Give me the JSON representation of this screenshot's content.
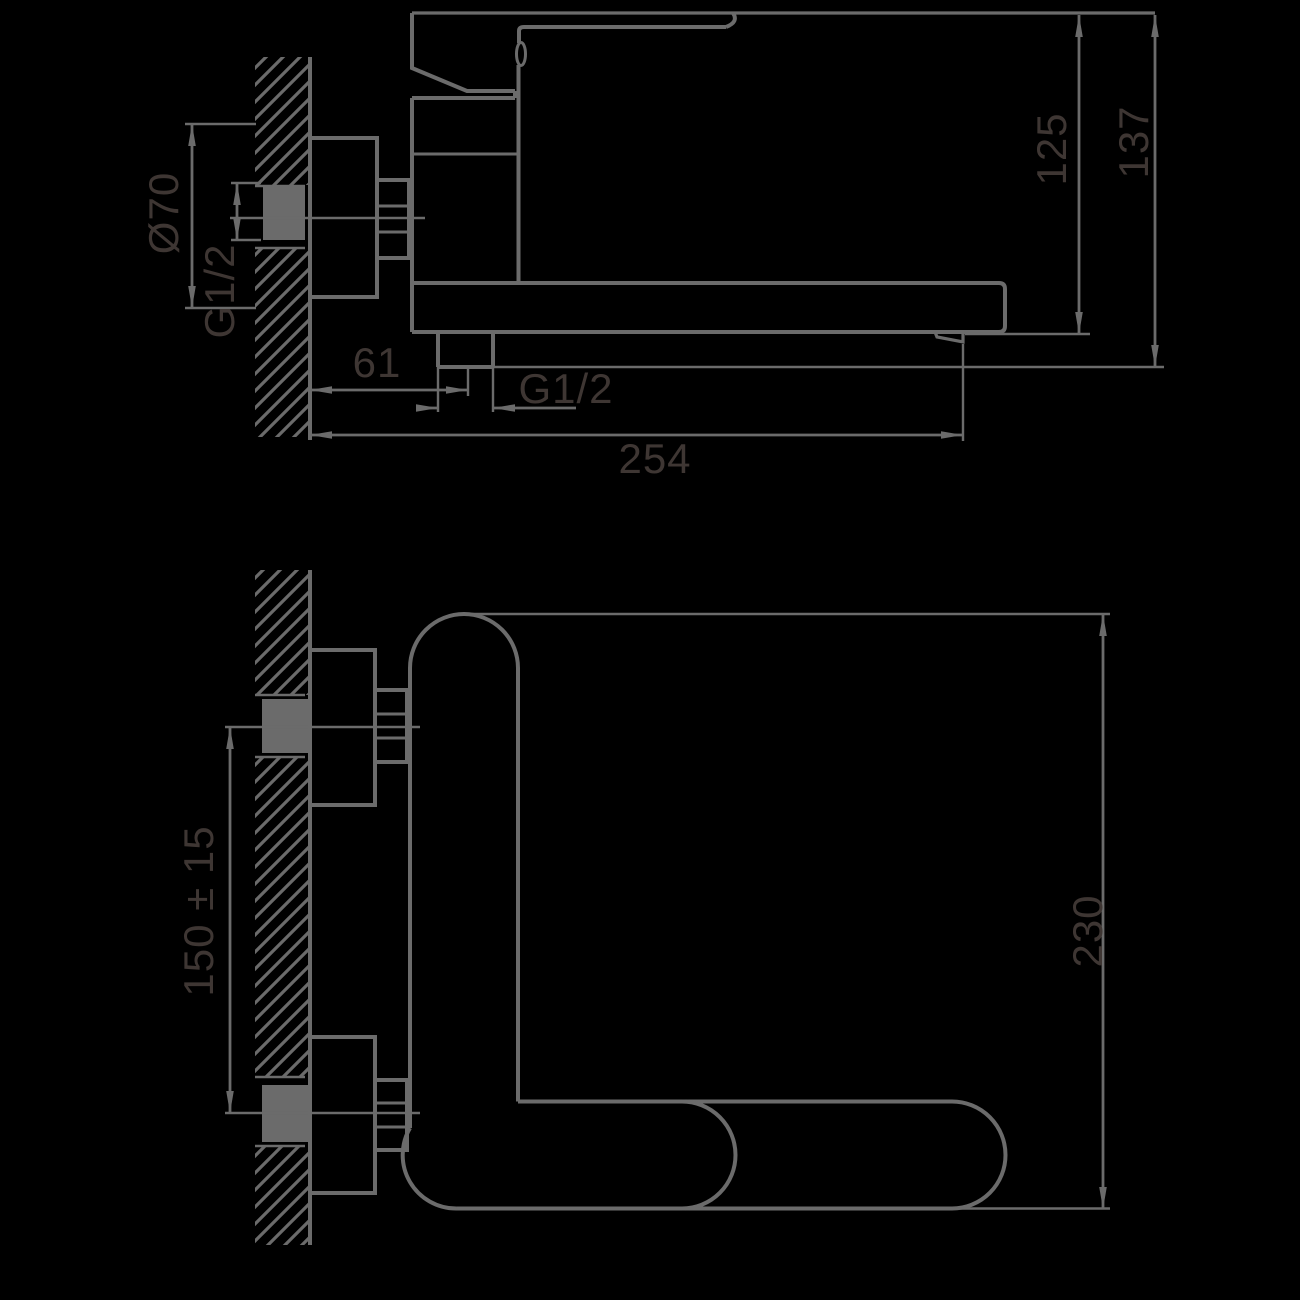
{
  "drawing": {
    "description": "wall-mounted single-lever mixer tap technical drawing, side view and plan view",
    "colors": {
      "background": "#000000",
      "line": "#6b6b6b",
      "text": "#3e3633"
    },
    "labels": {
      "flange_diameter": "Ø70",
      "inlet_thread": "G1/2",
      "outlet_offset": "61",
      "outlet_thread": "G1/2",
      "spout_reach": "254",
      "height_to_spout": "125",
      "overall_height": "137",
      "inlet_spacing": "150 ± 15",
      "overall_depth": "230"
    }
  }
}
